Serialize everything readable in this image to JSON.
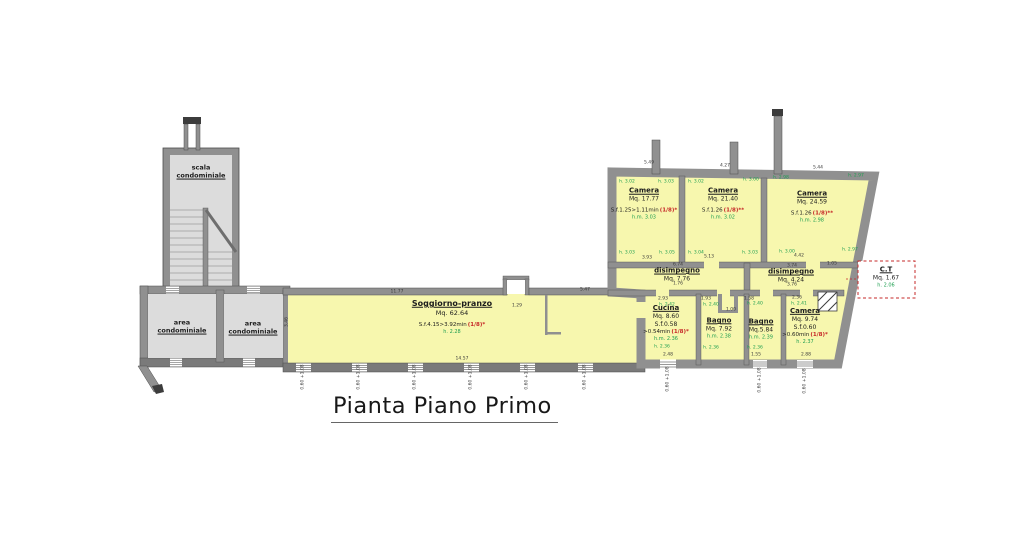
{
  "title": "Pianta Piano Primo",
  "colors": {
    "room_fill": "#f7f7ae",
    "common_fill": "#dcdcdc",
    "wall": "#909090",
    "accent_red": "#c62828",
    "accent_green": "#1e9e50"
  },
  "rooms": {
    "scala": {
      "l1": "scala",
      "l2": "condominiale"
    },
    "area1": {
      "l1": "area",
      "l2": "condominiale"
    },
    "area2": {
      "l1": "area",
      "l2": "condominiale"
    },
    "soggiorno": {
      "title": "Soggiorno-pranzo",
      "mq": "Mq. 62.64",
      "sf": "S.f.4.15>3.92min",
      "sf_red": "(1/8)*",
      "h": "h. 2.28"
    },
    "camera1": {
      "title": "Camera",
      "mq": "Mq. 17.77",
      "sf": "S.f.1.25>1.11min",
      "sf_red": "(1/8)*",
      "h": "h.m. 3.03"
    },
    "camera2": {
      "title": "Camera",
      "mq": "Mq. 21.40",
      "sf": "S.f.1.26",
      "sf_red": "(1/8)**",
      "h": "h.m. 3.02"
    },
    "camera3": {
      "title": "Camera",
      "mq": "Mq. 24.59",
      "sf": "S.f.1.26",
      "sf_red": "(1/8)**",
      "h": "h.m. 2.98"
    },
    "disimpegno1": {
      "title": "disimpegno",
      "mq": "Mq. 7.76"
    },
    "disimpegno2": {
      "title": "disimpegno",
      "mq": "Mq. 4.24"
    },
    "cucina": {
      "title": "Cucina",
      "mq": "Mq. 8.60",
      "sf2": "S.f.0.58",
      "sf": ">0.54min",
      "sf_red": "(1/8)*",
      "h": "h.m. 2.36"
    },
    "bagno1": {
      "title": "Bagno",
      "mq": "Mq. 7.92",
      "h": "h.m. 2.38"
    },
    "bagno2": {
      "title": "Bagno",
      "mq": "Mq.5.84",
      "h": "h.m. 2.39"
    },
    "camera4": {
      "title": "Camera",
      "mq": "Mq. 9.74",
      "sf2": "S.f.0.60",
      "sf": ">0.60min",
      "sf_red": "(1/8)*",
      "h": "h. 2.37"
    },
    "ct": {
      "title": "C.T",
      "mq": "Mq. 1.67",
      "h": "h. 2.06"
    }
  },
  "dim_labels": [
    {
      "t": "5.49",
      "x": 649,
      "y": 163
    },
    {
      "t": "4.27",
      "x": 725,
      "y": 166
    },
    {
      "t": "5.44",
      "x": 818,
      "y": 168
    },
    {
      "t": "h. 3.02",
      "x": 627,
      "y": 182,
      "c": "g"
    },
    {
      "t": "h. 3.03",
      "x": 666,
      "y": 182,
      "c": "g"
    },
    {
      "t": "h. 3.03",
      "x": 627,
      "y": 253,
      "c": "g"
    },
    {
      "t": "h. 3.05",
      "x": 667,
      "y": 253,
      "c": "g"
    },
    {
      "t": "h. 3.02",
      "x": 696,
      "y": 182,
      "c": "g"
    },
    {
      "t": "h. 3.00",
      "x": 751,
      "y": 180,
      "c": "g"
    },
    {
      "t": "h. 3.04",
      "x": 696,
      "y": 253,
      "c": "g"
    },
    {
      "t": "h. 3.03",
      "x": 750,
      "y": 253,
      "c": "g"
    },
    {
      "t": "h. 2.98",
      "x": 781,
      "y": 178,
      "c": "g"
    },
    {
      "t": "h. 2.97",
      "x": 856,
      "y": 176,
      "c": "g"
    },
    {
      "t": "h. 3.00",
      "x": 787,
      "y": 252,
      "c": "g"
    },
    {
      "t": "h. 2.97",
      "x": 850,
      "y": 250,
      "c": "g"
    },
    {
      "t": "3.93",
      "x": 647,
      "y": 258
    },
    {
      "t": "5.13",
      "x": 709,
      "y": 257
    },
    {
      "t": "4.42",
      "x": 799,
      "y": 256
    },
    {
      "t": "1.05",
      "x": 832,
      "y": 264
    },
    {
      "t": "6.74",
      "x": 678,
      "y": 265
    },
    {
      "t": "1.76",
      "x": 678,
      "y": 284
    },
    {
      "t": "3.74",
      "x": 792,
      "y": 266
    },
    {
      "t": "3.76",
      "x": 792,
      "y": 285
    },
    {
      "t": "2.93",
      "x": 663,
      "y": 299
    },
    {
      "t": "1.93",
      "x": 706,
      "y": 299
    },
    {
      "t": "1.58",
      "x": 749,
      "y": 299
    },
    {
      "t": "2.36",
      "x": 797,
      "y": 298
    },
    {
      "t": "h. 2.42",
      "x": 667,
      "y": 305,
      "c": "g"
    },
    {
      "t": "h. 2.40",
      "x": 711,
      "y": 305,
      "c": "g"
    },
    {
      "t": "h. 2.40",
      "x": 755,
      "y": 304,
      "c": "g"
    },
    {
      "t": "h. 2.41",
      "x": 799,
      "y": 304,
      "c": "g"
    },
    {
      "t": "1.00",
      "x": 731,
      "y": 310
    },
    {
      "t": "h. 2.36",
      "x": 662,
      "y": 347,
      "c": "g"
    },
    {
      "t": "2.48",
      "x": 668,
      "y": 355
    },
    {
      "t": "h. 2.36",
      "x": 711,
      "y": 348,
      "c": "g"
    },
    {
      "t": "h. 2.36",
      "x": 755,
      "y": 348,
      "c": "g"
    },
    {
      "t": "1.55",
      "x": 756,
      "y": 355
    },
    {
      "t": "2.88",
      "x": 806,
      "y": 355
    },
    {
      "t": "11.77",
      "x": 397,
      "y": 292
    },
    {
      "t": "5.47",
      "x": 585,
      "y": 290
    },
    {
      "t": "1.29",
      "x": 517,
      "y": 306
    },
    {
      "t": "14.57",
      "x": 462,
      "y": 359
    },
    {
      "t": "3.46",
      "x": 287,
      "y": 322,
      "r": -90
    },
    {
      "t": "0.60 +1.08",
      "x": 303,
      "y": 377,
      "r": -90
    },
    {
      "t": "0.60 +1.08",
      "x": 359,
      "y": 377,
      "r": -90
    },
    {
      "t": "0.60 +1.08",
      "x": 415,
      "y": 377,
      "r": -90
    },
    {
      "t": "0.60 +1.08",
      "x": 471,
      "y": 377,
      "r": -90
    },
    {
      "t": "0.60 +1.08",
      "x": 527,
      "y": 377,
      "r": -90
    },
    {
      "t": "0.60 +1.08",
      "x": 585,
      "y": 377,
      "r": -90
    },
    {
      "t": "0.60 +1.08",
      "x": 668,
      "y": 379,
      "r": -90
    },
    {
      "t": "0.60 +1.08",
      "x": 760,
      "y": 380,
      "r": -90
    },
    {
      "t": "0.60 +1.08",
      "x": 805,
      "y": 381,
      "r": -90
    }
  ]
}
